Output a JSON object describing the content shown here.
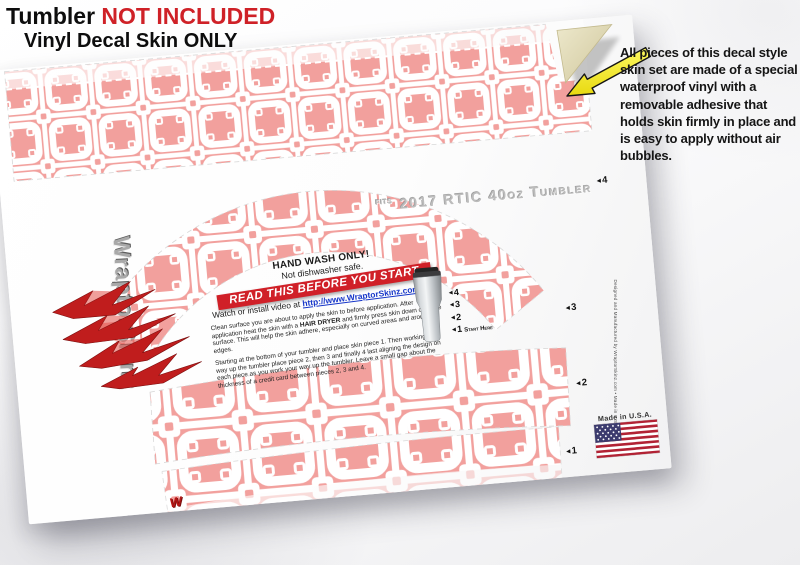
{
  "header": {
    "line1_prefix": "Tumbler ",
    "line1_highlight": "NOT INCLUDED",
    "line2": "Vinyl Decal Skin ONLY"
  },
  "annotation": {
    "text": "All pieces of this decal style skin set are made of a special waterproof vinyl with a removable adhesive that holds skin firmly in place and is easy to apply without air bubbles."
  },
  "sheet": {
    "fits_prefix": "FITS",
    "fits_label": "2017 RTIC 40oz Tumbler",
    "care_heading": "HAND WASH ONLY!",
    "care_sub": "Not dishwasher safe.",
    "banner": "READ THIS BEFORE YOU START",
    "video_prefix": "Watch or install video at ",
    "video_link": "http://www.WraptorSkinz.com/Help",
    "para1_pre": "Clean surface you are about to apply the skin to before application. After application heat the skin with a ",
    "para1_bold": "HAIR DRYER",
    "para1_post": " and firmly press skin down onto the surface. This will help the skin adhere, especially on curved areas and around edges.",
    "para2": "Starting at the bottom of your tumbler and place skin piece 1. Then working your way up the tumbler place piece 2, then 3 and finally 4 last aligning the design on each piece as you work your way up the tumbler. Leave a small gap about the thickness of a credit card between pieces 2, 3 and 4.",
    "legend": [
      {
        "arrow": "◄",
        "n": "4",
        "note": ""
      },
      {
        "arrow": "◄",
        "n": "3",
        "note": ""
      },
      {
        "arrow": "◄",
        "n": "2",
        "note": ""
      },
      {
        "arrow": "◄",
        "n": "1",
        "note": "Start Here"
      }
    ],
    "markers": [
      {
        "arrow": "◄",
        "n": "4"
      },
      {
        "arrow": "◄",
        "n": "3"
      },
      {
        "arrow": "◄",
        "n": "2"
      },
      {
        "arrow": "◄",
        "n": "1"
      }
    ],
    "made_in": "Made in U.S.A.",
    "fine_print": "Designed and Manufactured by WraptorSkinz.com • Made in U.S.A.",
    "brand_mark": "W"
  },
  "logo": {
    "brand": "WraptorSkinz"
  },
  "colors": {
    "pattern_pink": "#f2a09d",
    "banner_red": "#d02028",
    "highlight_red": "#cf2127",
    "arrow_yellow": "#f6ef35",
    "backing_tan": "#e0d9b4",
    "link_blue": "#1535c9"
  }
}
